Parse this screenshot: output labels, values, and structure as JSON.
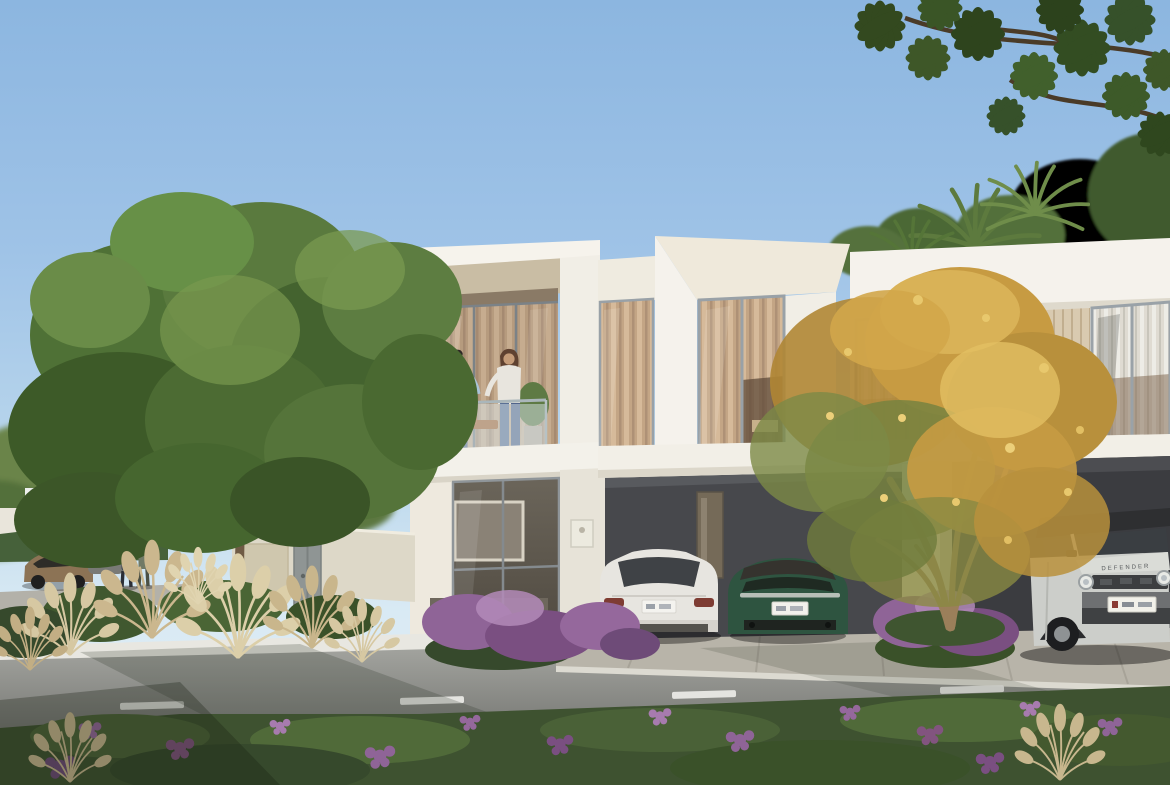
{
  "scene": {
    "type": "architectural-exterior-render",
    "setting": "Modern two-storey cream townhouses with recessed balcony, carports and landscaped street frontage",
    "time_of_day": "daytime-clear-sky",
    "sky": {
      "top_color": "#8cb6e0",
      "horizon_color": "#e3eef5"
    },
    "buildings": {
      "facade_color": "#f3f0e9",
      "soffit_color": "#c9bda4",
      "slat_panel_color": "#d9cab0",
      "window_frame_color": "#9aa1a7",
      "curtain_color": "#c9ad90",
      "carport_interior_color": "#47484c",
      "units_visible": 2
    },
    "people": {
      "balcony_couple_count": 2,
      "street_pedestrian_count": 2
    },
    "vehicles": {
      "white_sedan": {
        "color": "#e7e5e0",
        "location": "left carport bay"
      },
      "green_coupe": {
        "color": "#2e5440",
        "location": "right of sedan in carport"
      },
      "silver_suv": {
        "color": "#cdcfca",
        "hood_text": "DEFENDER",
        "location": "right carport"
      },
      "bronze_car": {
        "color": "#8c7355",
        "location": "street far left"
      },
      "grey_car": {
        "color": "#797a76",
        "location": "street far left"
      }
    },
    "vegetation": {
      "large_green_tree_color": "#5a7a3e",
      "yellow_flowering_tree_color": "#d2a64a",
      "palm_frond_color": "#5d7a3e",
      "pampas_grass_color": "#d6c8a2",
      "purple_flower_color": "#95689c",
      "hedge_color": "#3d5531"
    },
    "street": {
      "asphalt_color": "#999a95",
      "curb_color": "#e8e7e1",
      "lane_marking": "dashed-white-center-line",
      "driveway_apron_color": "#b8b4a9"
    }
  }
}
